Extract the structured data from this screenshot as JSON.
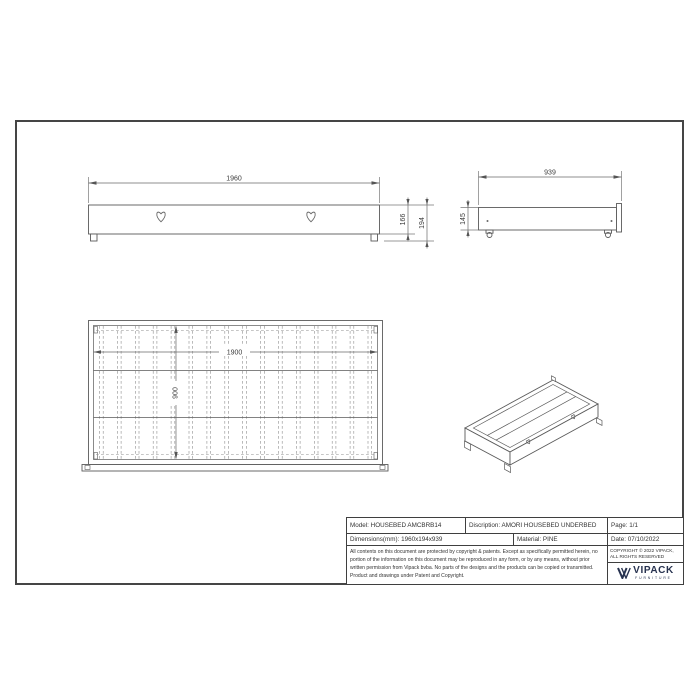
{
  "drawing": {
    "front_view": {
      "width": "1960",
      "panel_height": "166",
      "total_height": "194"
    },
    "side_view": {
      "depth": "939",
      "height": "145"
    },
    "top_view": {
      "inner_length": "1900",
      "inner_width": "900"
    }
  },
  "title_block": {
    "model": "Model: HOUSEBED AMCBRB14",
    "description": "Discription: AMORI HOUSEBED UNDERBED",
    "page": "Page: 1/1",
    "dimensions": "Dimensions(mm): 1960x194x939",
    "material": "Material: PINE",
    "date": "Date: 07/10/2022",
    "legal": "All contents on this document are protected by copyright & patents. Except as specifically permitted herein, no portion of the information on this document may be reproduced in any form, or by any means, without prior written permission from Vipack bvba. No parts of the designs and the products can be copied or transmitted. Product and drawings under Patent and Copyright.",
    "copyright": "COPYRIGHT © 2022 VIPACK, ALL RIGHTS RESERVED",
    "brand": "VIPACK",
    "brand_sub": "FURNITURE"
  },
  "colors": {
    "line": "#5a5a5a",
    "dim_line": "#6a6a6a",
    "text": "#3c3c3c",
    "frame": "#454545",
    "brand_navy": "#27324f"
  }
}
